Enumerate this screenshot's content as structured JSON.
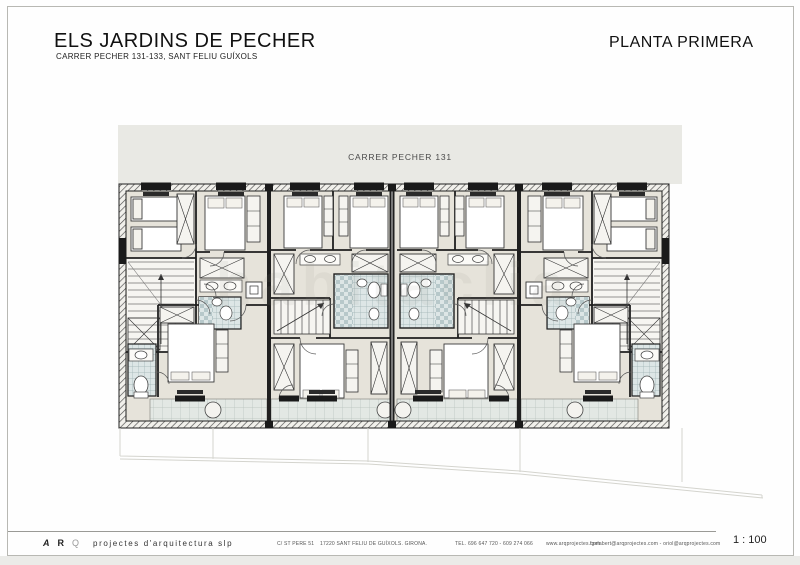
{
  "header": {
    "title": "ELS JARDINS DE PECHER",
    "subtitle": "CARRER PECHER 131-133, SANT FELIU GUÍXOLS",
    "plan_name": "PLANTA PRIMERA"
  },
  "plan": {
    "street_label": "CARRER PECHER 131",
    "watermark": "habitaclia"
  },
  "footer": {
    "logo_a": "A",
    "logo_r": "R",
    "logo_q": "Q",
    "logo_words": "projectes d'arquitectura slp",
    "address": "C/ ST PERE 51",
    "city": "17220 SANT FELIU DE GUÍXOLS. GIRONA.",
    "tel": "TEL. 696 647 720 - 609 274 066",
    "web": "www.arqprojectes.com",
    "email": "fgelabert@arqprojectes.com - oriol@arqprojectes.com",
    "scale": "1 : 100"
  },
  "colors": {
    "street_band": "#e9e9e4",
    "floor": "#e6e3da",
    "bath_tile": "#dde6e6",
    "wall": "#1f1f1f",
    "plot_line": "#d4d4ce"
  }
}
